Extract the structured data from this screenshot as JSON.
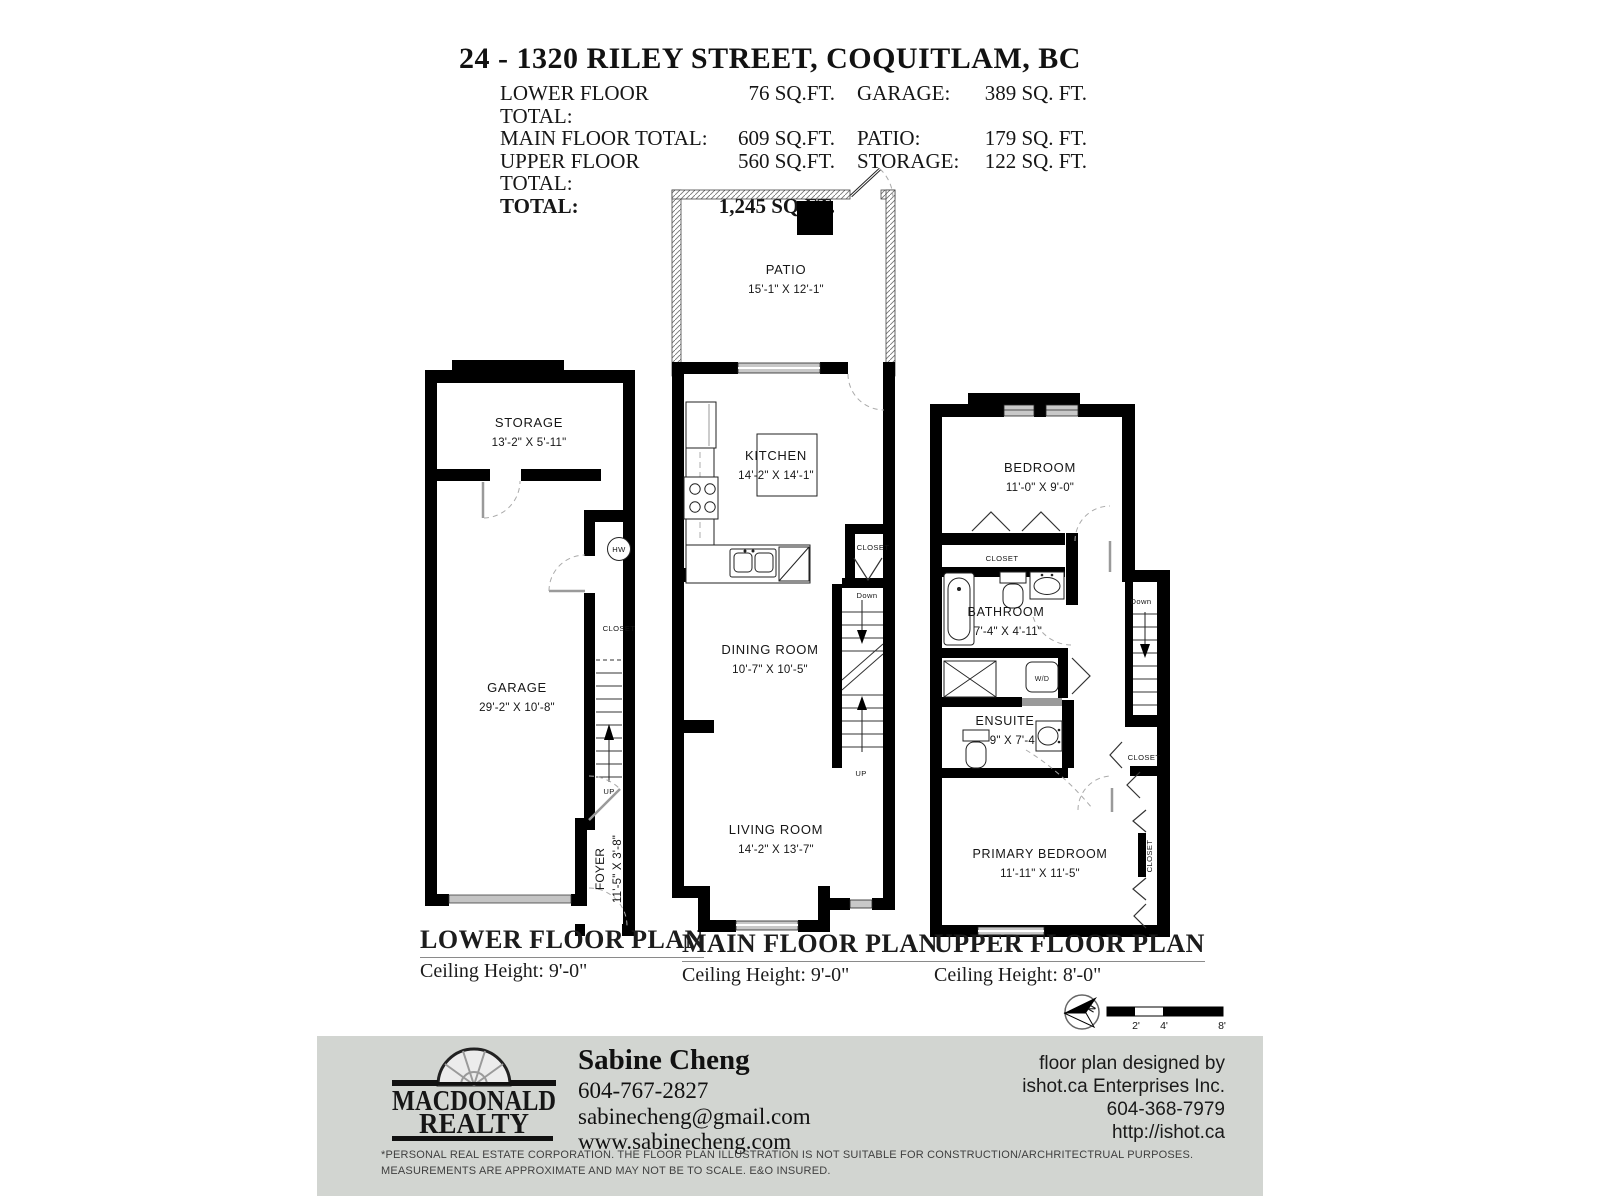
{
  "header": {
    "title": "24 - 1320 RILEY STREET, COQUITLAM, BC",
    "rows": [
      {
        "l1": "LOWER FLOOR TOTAL:",
        "v1": "76 SQ.FT.",
        "l2": "GARAGE:",
        "v2": "389 SQ. FT."
      },
      {
        "l1": "MAIN FLOOR TOTAL:",
        "v1": "609 SQ.FT.",
        "l2": "PATIO:",
        "v2": "179 SQ. FT."
      },
      {
        "l1": "UPPER FLOOR TOTAL:",
        "v1": "560 SQ.FT.",
        "l2": "STORAGE:",
        "v2": "122 SQ. FT."
      },
      {
        "l1": "TOTAL:",
        "v1": "1,245 SQ.FT.",
        "l2": "",
        "v2": ""
      }
    ]
  },
  "plans": {
    "lower": {
      "title": "LOWER FLOOR PLAN",
      "ceiling": "Ceiling Height: 9'-0\"",
      "storage": {
        "name": "STORAGE",
        "dims": "13'-2\" X 5'-11\""
      },
      "garage": {
        "name": "GARAGE",
        "dims": "29'-2\" X 10'-8\""
      },
      "foyer": {
        "name": "FOYER",
        "dims": "11'-5\" X 3'-8\""
      },
      "closet": "CLOSET",
      "hw": "HW",
      "up": "UP"
    },
    "main": {
      "title": "MAIN FLOOR PLAN",
      "ceiling": "Ceiling Height: 9'-0\"",
      "patio": {
        "name": "PATIO",
        "dims": "15'-1\" X 12'-1\""
      },
      "kitchen": {
        "name": "KITCHEN",
        "dims": "14'-2\" X 14'-1\""
      },
      "dining": {
        "name": "DINING ROOM",
        "dims": "10'-7\" X 10'-5\""
      },
      "living": {
        "name": "LIVING ROOM",
        "dims": "14'-2\" X 13'-7\""
      },
      "closet": "CLOSET",
      "down": "Down",
      "up": "UP"
    },
    "upper": {
      "title": "UPPER FLOOR PLAN",
      "ceiling": "Ceiling Height: 8'-0\"",
      "bedroom": {
        "name": "BEDROOM",
        "dims": "11'-0\" X 9'-0\""
      },
      "bathroom": {
        "name": "BATHROOM",
        "dims": "7'-4\" X 4'-11\""
      },
      "ensuite": {
        "name": "ENSUITE",
        "dims": "7'-9\" X 7'-4\""
      },
      "primary": {
        "name": "PRIMARY BEDROOM",
        "dims": "11'-11\" X 11'-5\""
      },
      "closet_bedroom": "CLOSET",
      "closet_hall": "CLOSET",
      "closet_primary": "CLOSET",
      "wd": "W/D",
      "down": "Down"
    }
  },
  "compass": {
    "north": "N"
  },
  "scale_bar": {
    "ticks": [
      "2'",
      "4'",
      "8'"
    ]
  },
  "footer": {
    "brand": {
      "name_top": "MACDONALD",
      "name_bottom": "REALTY"
    },
    "agent": {
      "name": "Sabine Cheng",
      "phone": "604-767-2827",
      "email": "sabinecheng@gmail.com",
      "website": "www.sabinecheng.com"
    },
    "designer": [
      "floor plan designed by",
      "ishot.ca Enterprises Inc.",
      "604-368-7979",
      "http://ishot.ca"
    ],
    "disclaimer": [
      "*PERSONAL REAL ESTATE CORPORATION. THE FLOOR PLAN ILLUSTRATION IS NOT SUITABLE FOR CONSTRUCTION/ARCHRITECTRUAL PURPOSES.",
      "MEASUREMENTS ARE APPROXIMATE AND MAY NOT BE TO SCALE. E&O INSURED."
    ],
    "colors": {
      "band": "#d2d5d1",
      "wall": "#000000"
    }
  }
}
